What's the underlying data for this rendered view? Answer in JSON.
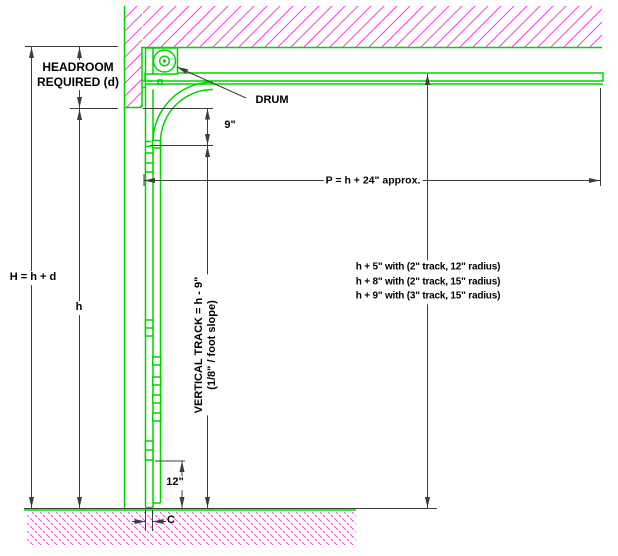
{
  "diagram": {
    "type": "sectional-overhead-door-headroom-section",
    "labels": {
      "headroom_line1": "HEADROOM",
      "headroom_line2": "REQUIRED (d)",
      "drum": "DRUM",
      "radius_height": "9\"",
      "horizontal_track_projection": "P = h + 24\" approx.",
      "note_line1": "h + 5\" with (2\" track, 12\" radius)",
      "note_line2": "h + 8\" with (2\" track, 15\" radius)",
      "note_line3": "h + 9\" with (3\" track, 15\" radius)",
      "total_height": "H = h + d",
      "opening_height": "h",
      "vertical_track_line1": "VERTICAL TRACK = h - 9\"",
      "vertical_track_line2": "(1/8\" / foot slope)",
      "bottom_roller_height": "12\"",
      "side_clearance": "C"
    },
    "colors": {
      "track_green": "#00d400",
      "hatch_magenta": "#ff3ce0",
      "dimension_gray": "#3c3c3c",
      "text_black": "#000000",
      "background": "#ffffff"
    }
  }
}
